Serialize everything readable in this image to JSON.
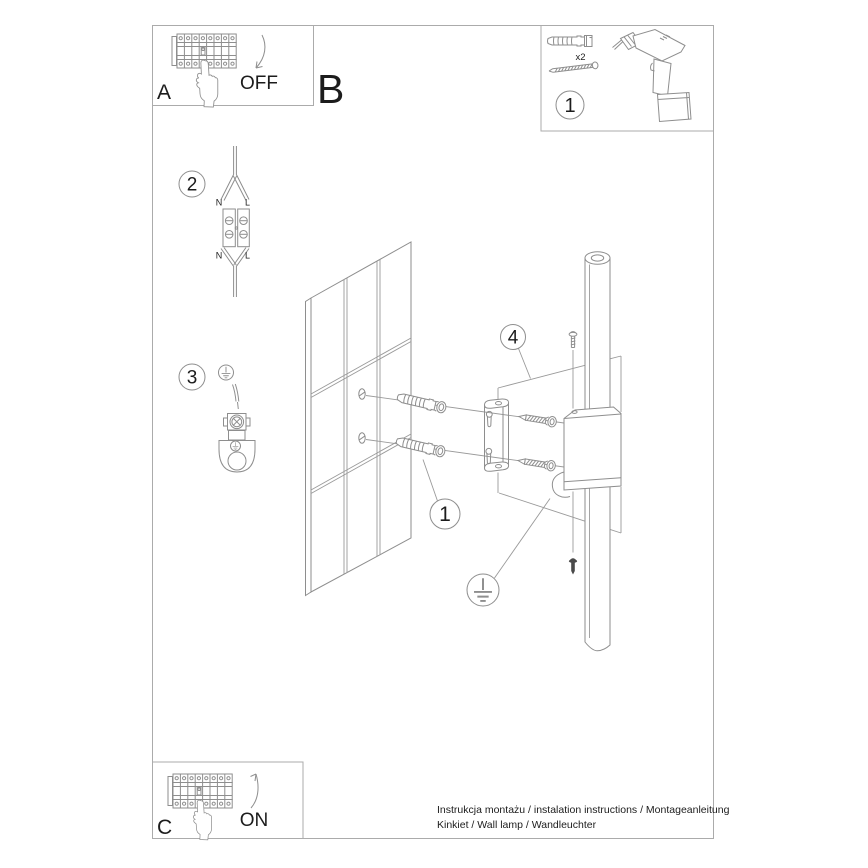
{
  "colors": {
    "background": "#ffffff",
    "line_art": "#8e8e8e",
    "frame_border": "#ababab",
    "text": "#1c1c1c",
    "dark_screw": "#4a4a4a"
  },
  "power_off_box": {
    "label": "A",
    "state": "OFF"
  },
  "section_label": "B",
  "parts_box": {
    "callout": "1",
    "anchor_qty": "x2"
  },
  "wiring_step": {
    "callout": "2",
    "terminal_labels": {
      "top_n": "N",
      "top_l": "L",
      "bottom_n": "N",
      "bottom_l": "L"
    }
  },
  "ground_step": {
    "callout": "3"
  },
  "mounting": {
    "anchor_callout": "1",
    "fixture_callout": "4"
  },
  "power_on_box": {
    "label": "C",
    "state": "ON"
  },
  "footer": {
    "line1": "Instrukcja montażu / instalation instructions / Montageanleitung",
    "line2": "Kinkiet / Wall lamp / Wandleuchter"
  }
}
